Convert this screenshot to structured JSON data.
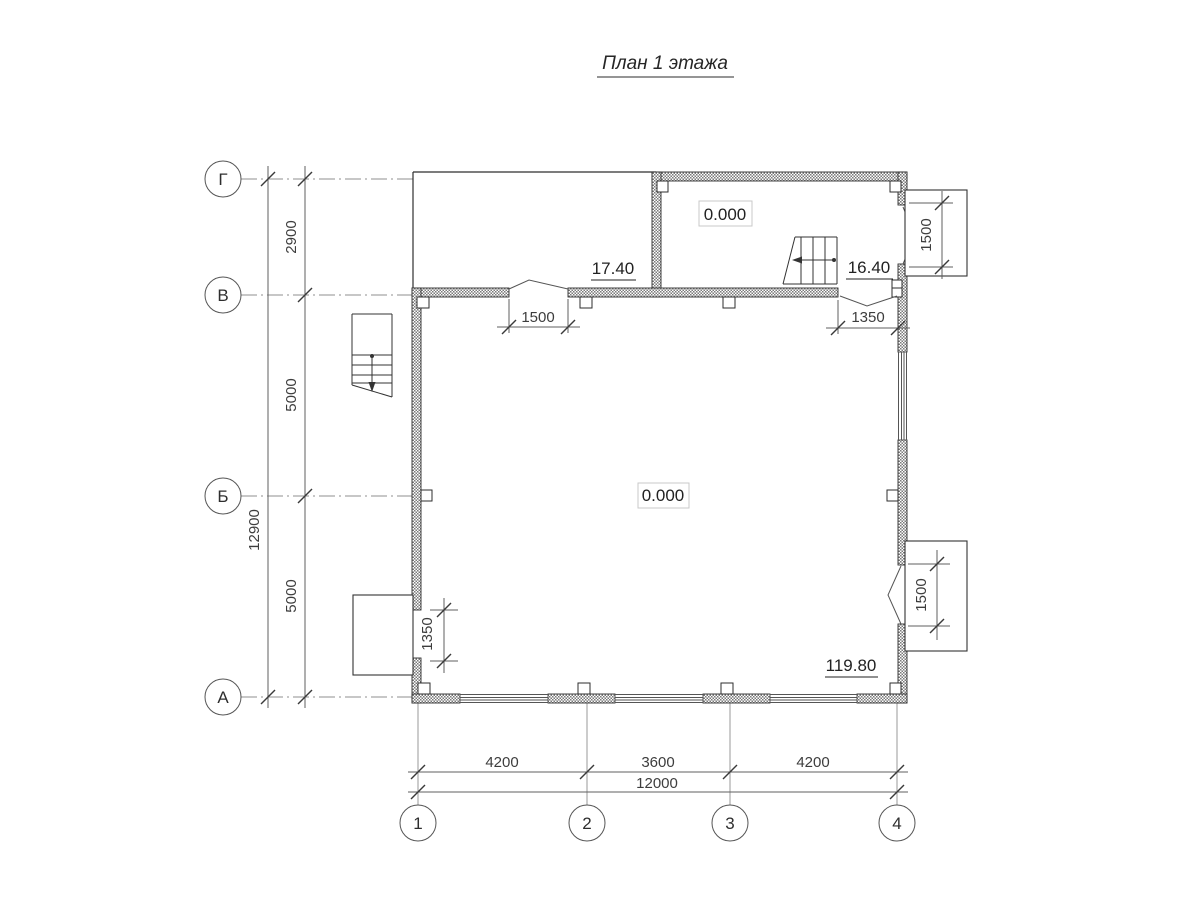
{
  "title": "План 1 этажа",
  "row_axes": {
    "labels": [
      "Г",
      "В",
      "Б",
      "А"
    ]
  },
  "col_axes": {
    "labels": [
      "1",
      "2",
      "3",
      "4"
    ]
  },
  "dims": {
    "left": {
      "seg_g_v": "2900",
      "seg_v_b": "5000",
      "seg_b_a": "5000",
      "total": "12900"
    },
    "bottom": {
      "seg_1_2": "4200",
      "seg_2_3": "3600",
      "seg_3_4": "4200",
      "total": "12000"
    },
    "openings": {
      "door_v_wall_left": "1500",
      "door_v_wall_right": "1350",
      "door_east_top": "1500",
      "door_east_bottom": "1500",
      "door_west_bottom": "1350"
    }
  },
  "levels": {
    "upper_room": "0.000",
    "main_room": "0.000",
    "terrace": "17.40",
    "stair": "16.40",
    "south_east": "119.80"
  },
  "colors": {
    "ink": "#2e2e2e",
    "thin_line": "#5f5f5f",
    "axis_line": "#8f8f8f",
    "hatch": "#7a7a7a",
    "label_frame": "#c9c9c9"
  }
}
